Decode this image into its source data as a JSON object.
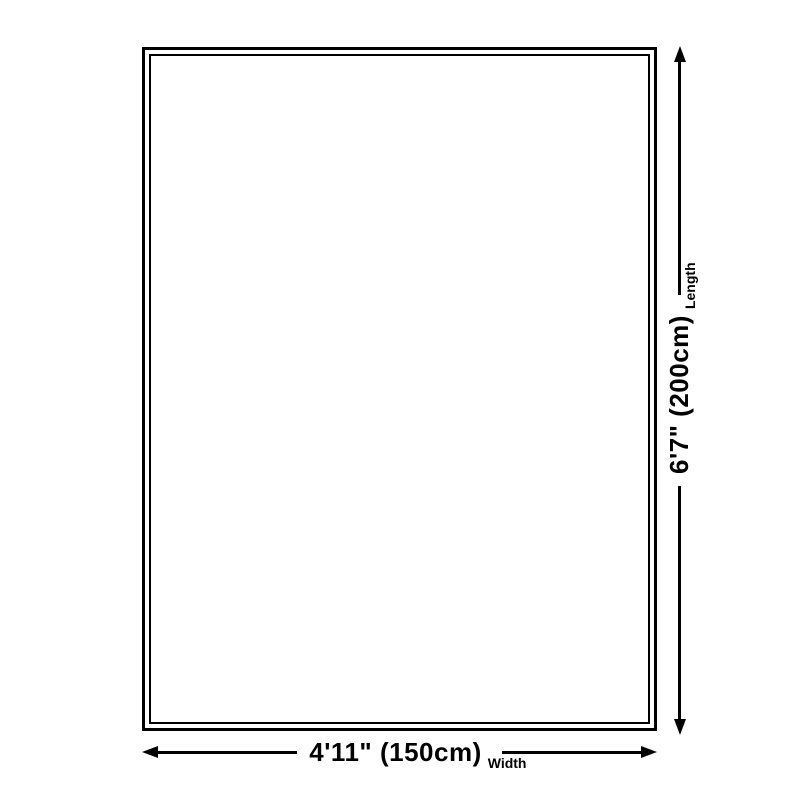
{
  "diagram": {
    "background": "#ffffff",
    "line_color": "#000000",
    "shape": "rectangle-outline-double-border",
    "length": {
      "value": "6'7\" (200cm)",
      "label": "Length"
    },
    "width": {
      "value": "4'11\" (150cm)",
      "label": "Width"
    }
  }
}
